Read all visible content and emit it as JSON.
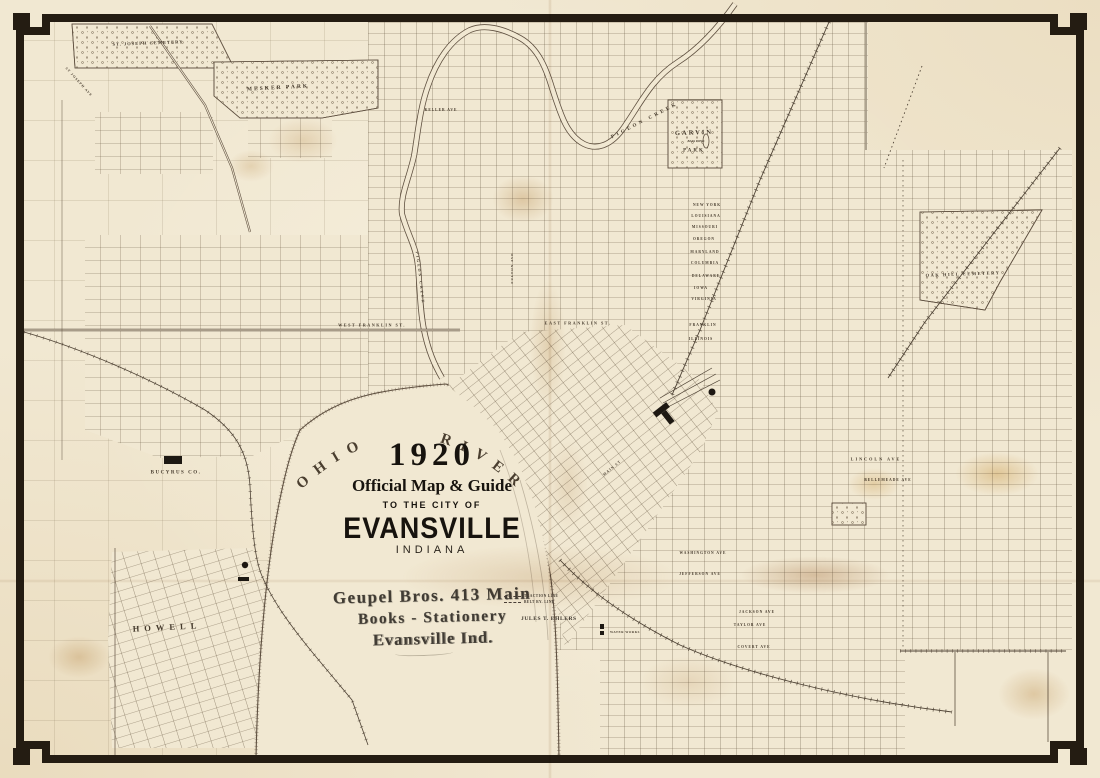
{
  "title_block": {
    "year": "1920",
    "line1": "Official Map & Guide",
    "line2": "TO THE CITY OF",
    "city": "EVANSVILLE",
    "state": "INDIANA"
  },
  "stamp": {
    "line1": "Geupel Bros. 413 Main",
    "line2": "Books - Stationery",
    "line3": "Evansville Ind."
  },
  "credit": "JULES T. EHLERS",
  "legend": {
    "items": [
      {
        "label": "TRACTION LINE"
      },
      {
        "label": "BELT RY. LINE"
      }
    ]
  },
  "colors": {
    "paper": "#f1e8d2",
    "ink": "#5f5040",
    "border": "#241c12",
    "label": "#453a2c"
  },
  "map": {
    "river_label": "OHIO RIVER",
    "labels": [
      {
        "id": "st-joseph-cemetery",
        "text": "ST. JOSEPH CEMETERY",
        "x": 148,
        "y": 43,
        "size": 4.5,
        "rot": -2,
        "ls": 1
      },
      {
        "id": "mesker-park",
        "text": "MESKER PARK",
        "x": 278,
        "y": 88,
        "size": 5.5,
        "rot": -3,
        "ls": 2
      },
      {
        "id": "pigeon-creek",
        "text": "PIGEON CREEK",
        "x": 645,
        "y": 121,
        "size": 5,
        "rot": -27,
        "ls": 3
      },
      {
        "id": "pigeon-creek-lower",
        "text": "PIGEON CREEK",
        "x": 420,
        "y": 278,
        "size": 3.8,
        "rot": 83,
        "ls": 2
      },
      {
        "id": "garvin",
        "text": "GARVIN",
        "x": 694,
        "y": 133,
        "size": 6.5,
        "rot": -2,
        "ls": 2,
        "bold": true
      },
      {
        "id": "bass-pond",
        "text": "BASS POND",
        "x": 696,
        "y": 141,
        "size": 3,
        "rot": 0,
        "ls": 0
      },
      {
        "id": "garvin-park",
        "text": "PARK",
        "x": 694,
        "y": 151,
        "size": 5,
        "rot": 0,
        "ls": 2
      },
      {
        "id": "oak-hill-cemetery",
        "text": "OAK HILL CEMETERY",
        "x": 963,
        "y": 274,
        "size": 4.5,
        "rot": -2,
        "ls": 1.5
      },
      {
        "id": "bucyrus-co",
        "text": "BUCYRUS CO.",
        "x": 176,
        "y": 473,
        "size": 5,
        "rot": 0,
        "ls": 1.5
      },
      {
        "id": "howell",
        "text": "HOWELL",
        "x": 167,
        "y": 627,
        "size": 8.5,
        "rot": -3,
        "ls": 5,
        "bold": true
      },
      {
        "id": "keller-ave",
        "text": "KELLER AVE",
        "x": 441,
        "y": 110,
        "size": 3.6,
        "rot": 0,
        "ls": 1
      },
      {
        "id": "west-franklin-st",
        "text": "WEST FRANKLIN ST.",
        "x": 372,
        "y": 325,
        "size": 4.2,
        "rot": 0,
        "ls": 1.5
      },
      {
        "id": "east-franklin-st",
        "text": "EAST FRANKLIN ST.",
        "x": 578,
        "y": 323,
        "size": 4.2,
        "rot": 0,
        "ls": 1.5
      },
      {
        "id": "new-york-ave",
        "text": "NEW YORK",
        "x": 707,
        "y": 205,
        "size": 3.6,
        "rot": 0,
        "ls": 1
      },
      {
        "id": "louisiana-st",
        "text": "LOUISIANA",
        "x": 706,
        "y": 216,
        "size": 3.6,
        "rot": 0,
        "ls": 1
      },
      {
        "id": "missouri-st",
        "text": "MISSOURI",
        "x": 705,
        "y": 227,
        "size": 3.6,
        "rot": 0,
        "ls": 1
      },
      {
        "id": "oregon-st",
        "text": "OREGON",
        "x": 704,
        "y": 239,
        "size": 3.6,
        "rot": 0,
        "ls": 1
      },
      {
        "id": "maryland-st",
        "text": "MARYLAND",
        "x": 705,
        "y": 252,
        "size": 3.6,
        "rot": 0,
        "ls": 1
      },
      {
        "id": "columbia-st",
        "text": "COLUMBIA",
        "x": 705,
        "y": 263,
        "size": 3.6,
        "rot": 0,
        "ls": 1
      },
      {
        "id": "delaware-st",
        "text": "DELAWARE",
        "x": 706,
        "y": 276,
        "size": 3.6,
        "rot": 0,
        "ls": 1
      },
      {
        "id": "iowa-st",
        "text": "IOWA",
        "x": 701,
        "y": 288,
        "size": 3.6,
        "rot": 0,
        "ls": 1
      },
      {
        "id": "virginia-st",
        "text": "VIRGINIA",
        "x": 704,
        "y": 299,
        "size": 3.6,
        "rot": 0,
        "ls": 1
      },
      {
        "id": "franklin-st",
        "text": "FRANKLIN",
        "x": 703,
        "y": 325,
        "size": 3.6,
        "rot": 0,
        "ls": 1
      },
      {
        "id": "illinois-st",
        "text": "ILLINOIS",
        "x": 701,
        "y": 339,
        "size": 3.6,
        "rot": 0,
        "ls": 1
      },
      {
        "id": "lincoln-ave",
        "text": "LINCOLN AVE",
        "x": 876,
        "y": 459,
        "size": 4.2,
        "rot": 0,
        "ls": 2
      },
      {
        "id": "bellemeade-ave",
        "text": "BELLEMEADE AVE",
        "x": 888,
        "y": 480,
        "size": 3.6,
        "rot": 0,
        "ls": 1
      },
      {
        "id": "washington-ave",
        "text": "WASHINGTON AVE",
        "x": 703,
        "y": 553,
        "size": 3.6,
        "rot": 0,
        "ls": 1
      },
      {
        "id": "jefferson-ave",
        "text": "JEFFERSON AVE",
        "x": 700,
        "y": 574,
        "size": 3.6,
        "rot": 0,
        "ls": 1
      },
      {
        "id": "jackson-ave",
        "text": "JACKSON AVE",
        "x": 757,
        "y": 612,
        "size": 3.6,
        "rot": 0,
        "ls": 1
      },
      {
        "id": "taylor-ave",
        "text": "TAYLOR AVE",
        "x": 750,
        "y": 625,
        "size": 3.6,
        "rot": 0,
        "ls": 1
      },
      {
        "id": "covert-ave",
        "text": "COVERT AVE",
        "x": 754,
        "y": 647,
        "size": 3.6,
        "rot": 0,
        "ls": 1
      },
      {
        "id": "st-joseph-ave",
        "text": "ST JOSEPH AVE",
        "x": 79,
        "y": 82,
        "size": 3.4,
        "rot": 48,
        "ls": 1
      },
      {
        "id": "water-works",
        "text": "WATER WORKS",
        "x": 625,
        "y": 632,
        "size": 3.2,
        "rot": 0,
        "ls": 0.5
      },
      {
        "id": "fulton-ave",
        "text": "FULTON AVE",
        "x": 512,
        "y": 268,
        "size": 3.4,
        "rot": -90,
        "ls": 1
      },
      {
        "id": "main-st",
        "text": "MAIN ST",
        "x": 612,
        "y": 468,
        "size": 3.6,
        "rot": -40,
        "ls": 1
      }
    ]
  }
}
